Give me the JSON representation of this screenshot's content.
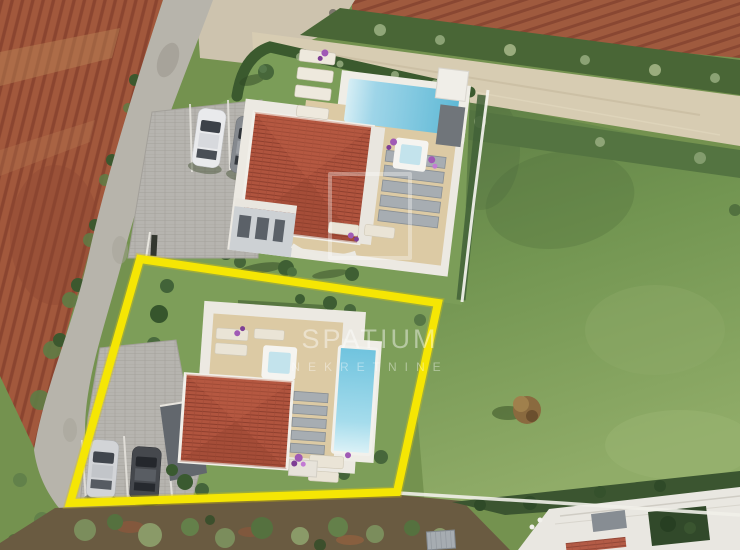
{
  "image": {
    "kind": "aerial drone photo of a real-estate listing (3D villa renders composited on site photo)",
    "setting": "two modern villas with pools beside a curving country road, red ploughed fields left and top, green meadow right"
  },
  "watermark": {
    "brand": "SPATIUM",
    "tagline": "NEKRETNINE",
    "logo": "square-outline-logo"
  },
  "highlight": {
    "shape": "yellow quadrilateral outline around the front plot",
    "points": "140,259 438,303 397,492 70,503",
    "color": "#F5E604"
  },
  "scene": {
    "upper_villa": {
      "roof": "red hip tile roof",
      "pool": "horizontal rectangular pool with white deck",
      "jacuzzi": "white square jacuzzi",
      "features": [
        "gray louvre pergola slats",
        "sun loungers on lawn",
        "purple bougainvillea pots",
        "paver parking"
      ],
      "parked_cars": [
        "white",
        "gray"
      ]
    },
    "highlighted_villa": {
      "roof": "red hip tile roof",
      "pool": "vertical rectangular pool with white rim",
      "jacuzzi": "white square jacuzzi",
      "features": [
        "gray skylight strips",
        "sun loungers",
        "purple flowers",
        "paver parking with marked stalls"
      ],
      "parked_cars": [
        "silver",
        "black"
      ]
    },
    "surroundings": [
      "red tilled field",
      "asphalt road",
      "pale gravel track with hedgerows",
      "large green meadow",
      "olive scrub strip",
      "neighbour house with white flat roof bottom-right",
      "white boundary fence lines",
      "brown autumn tree on meadow"
    ]
  },
  "palette": {
    "field_red": "#A25A3D",
    "road_gray": "#B7B4AB",
    "gravel_track": "#D7CCB2",
    "meadow_green": "#729551",
    "lawn_green": "#7B9D58",
    "hedge_dark": "#3E5C30",
    "roof_red": "#B0543E",
    "terrace_beige": "#DCCAA4",
    "villa_white": "#ECE9E2",
    "pool_blue": "#66BFDC",
    "paver_gray": "#B6B4AF",
    "highlight_yellow": "#F5E604",
    "watermark_white": "rgba(255,255,255,0.42)"
  }
}
